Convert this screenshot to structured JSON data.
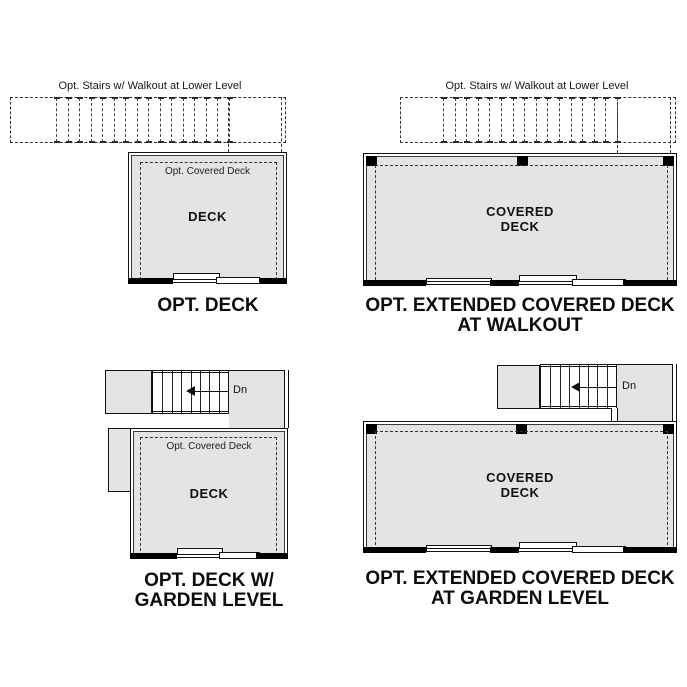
{
  "colors": {
    "deck_fill": "#e4e4e4",
    "wall": "#000000",
    "line": "#1a1a1a"
  },
  "shared": {
    "stairs_note": "Opt. Stairs w/ Walkout at Lower Level",
    "covered_deck_note": "Opt. Covered Deck",
    "down_label": "Dn"
  },
  "panels": {
    "opt_deck": {
      "room_line1": "DECK",
      "caption_line1": "OPT. DECK"
    },
    "walkout": {
      "room_line1": "COVERED",
      "room_line2": "DECK",
      "caption_line1": "OPT. EXTENDED COVERED DECK",
      "caption_line2": "AT WALKOUT"
    },
    "garden_deck": {
      "room_line1": "DECK",
      "caption_line1": "OPT. DECK W/",
      "caption_line2": "GARDEN LEVEL"
    },
    "garden_covered": {
      "room_line1": "COVERED",
      "room_line2": "DECK",
      "caption_line1": "OPT. EXTENDED COVERED DECK",
      "caption_line2": "AT GARDEN LEVEL"
    }
  }
}
